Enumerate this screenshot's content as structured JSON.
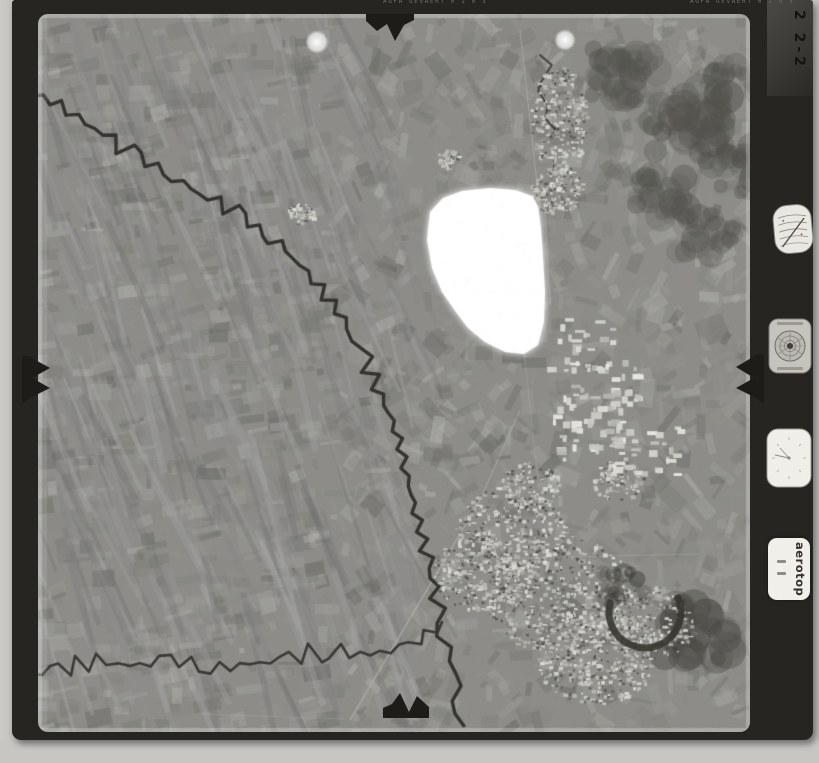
{
  "film": {
    "edge_text_left": "AGFA GEVAERT  0 1 0 3",
    "edge_text_right": "AGFA GEVAERT  0 1 0 3",
    "frame_number": "2 2-2"
  },
  "instruments": {
    "label_text": "aerotop"
  },
  "colors": {
    "paper": "#c8c7c4",
    "film": "#262522",
    "photo_base": "#8d8c88",
    "river": "#34332f",
    "blob": "#ffffff"
  }
}
